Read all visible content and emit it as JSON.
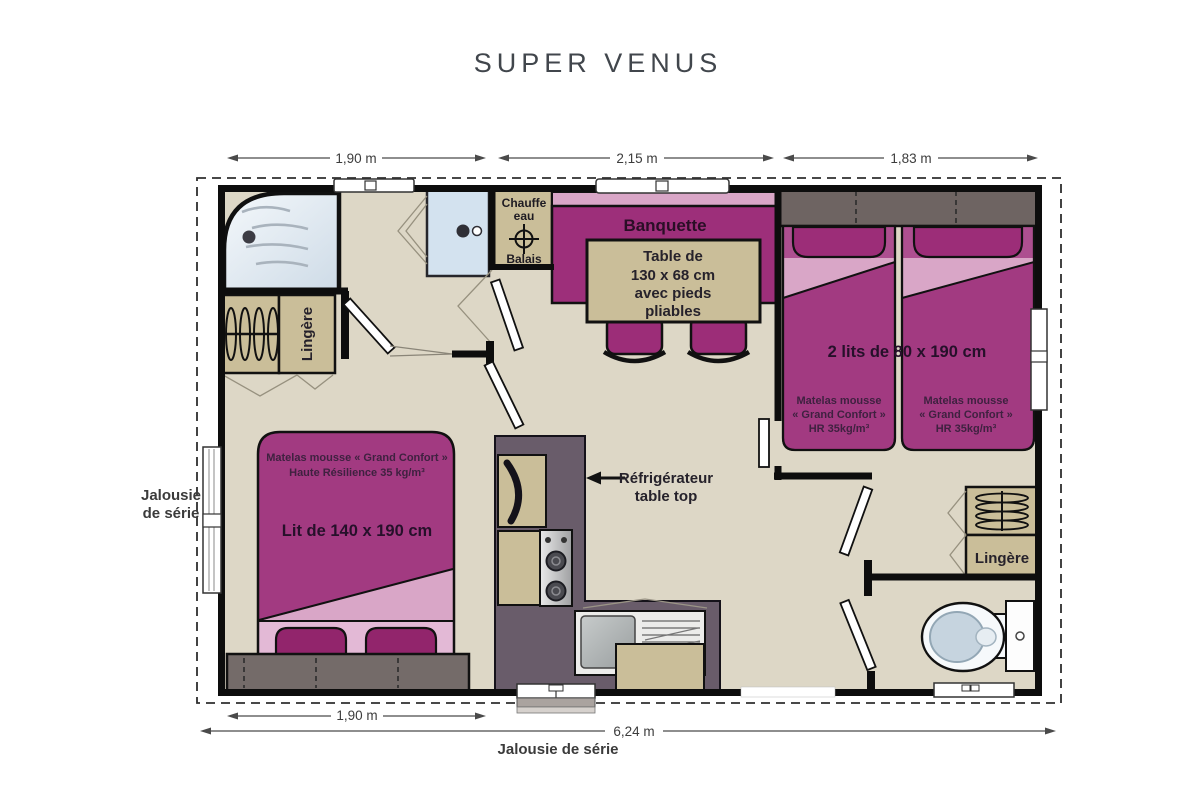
{
  "title": "SUPER VENUS",
  "dimensions": {
    "top_left": "1,90 m",
    "top_middle": "2,15 m",
    "top_right": "1,83 m",
    "bottom_left": "1,90 m",
    "bottom_total": "6,24 m"
  },
  "exterior": {
    "jalousie_left_line1": "Jalousie",
    "jalousie_left_line2": "de série",
    "jalousie_bottom": "Jalousie de série"
  },
  "rooms": {
    "utility": {
      "line1": "Chauffe",
      "line2": "eau",
      "line3": "Balais"
    },
    "wardrobe_bath": "Lingère",
    "wardrobe_right": "Lingère",
    "living": {
      "banquette": "Banquette",
      "table_line1": "Table de",
      "table_line2": "130 x 68 cm",
      "table_line3": "avec pieds",
      "table_line4": "pliables"
    },
    "kitchen": {
      "fridge_line1": "Réfrigérateur",
      "fridge_line2": "table top"
    },
    "twin_bedroom": {
      "beds": "2 lits de 80 x 190 cm",
      "mattress_line1": "Matelas mousse",
      "mattress_line2": "« Grand Confort »",
      "mattress_line3": "HR 35kg/m³"
    },
    "master_bedroom": {
      "mattress_line1": "Matelas mousse « Grand Confort »",
      "mattress_line2": "Haute Résilience 35 kg/m³",
      "bed": "Lit de 140 x 190 cm"
    }
  },
  "colors": {
    "purple": "#a23a81",
    "purple_dark": "#9c2d78",
    "pink": "#d9a6c7",
    "tan": "#cabe99",
    "floor": "#ddd7c6",
    "wall": "#111111",
    "counter": "#695c6a",
    "headboard": "#6e6462"
  }
}
